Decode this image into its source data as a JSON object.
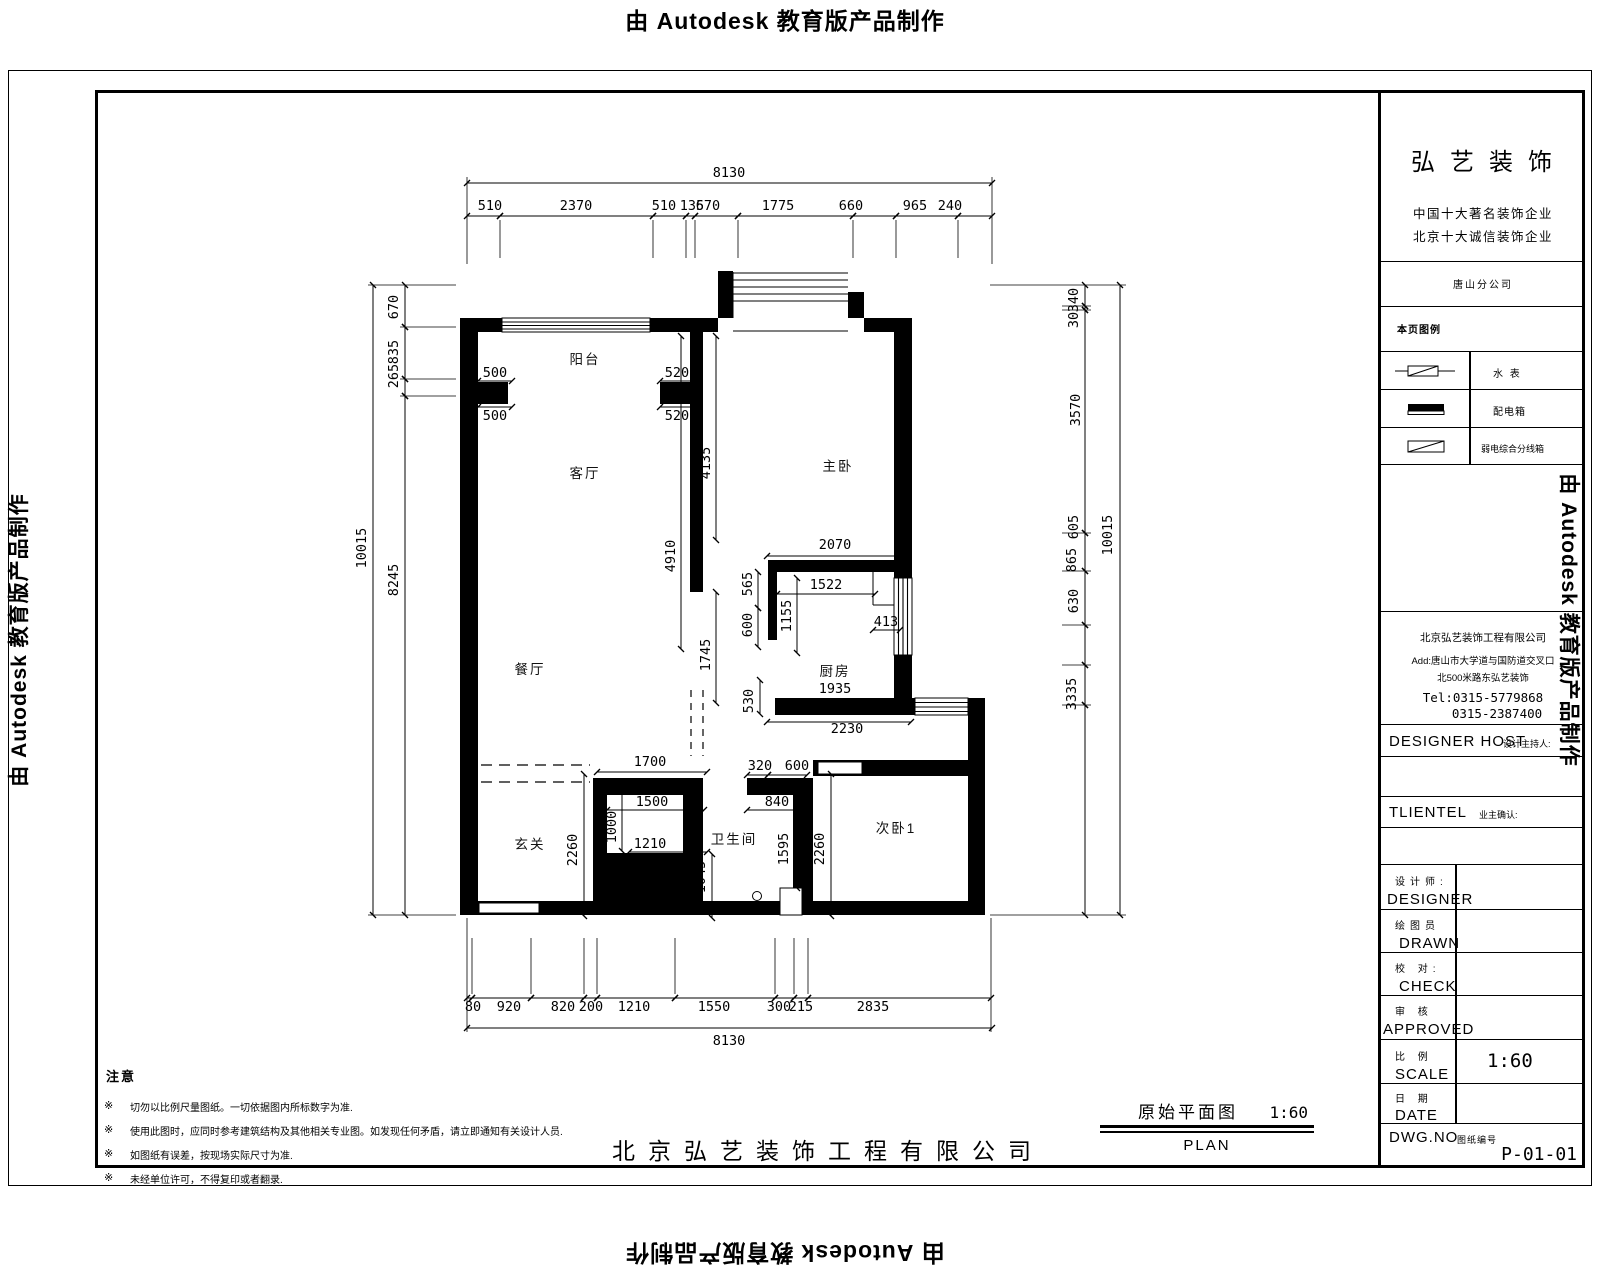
{
  "watermark": {
    "pre": "由",
    "brand": "Autodesk",
    "post": "教育版产品制作"
  },
  "title_block": {
    "logo": "弘艺装饰",
    "slogan1": "中国十大著名装饰企业",
    "slogan2": "北京十大诚信装饰企业",
    "branch": "唐山分公司",
    "legend_title": "本页图例",
    "legend": [
      {
        "icon": "water-meter",
        "label": "水  表"
      },
      {
        "icon": "distribution-box",
        "label": "配电箱"
      },
      {
        "icon": "weak-current-box",
        "label": "弱电综合分线箱"
      }
    ],
    "company": "北京弘艺装饰工程有限公司",
    "address1": "Add:唐山市大学道与国防道交叉口",
    "address2": "北500米路东弘艺装饰",
    "tel1": "Tel:0315-5779868",
    "tel2": "0315-2387400",
    "host_en": "DESIGNER HOST",
    "host_zh": "设计主持人:",
    "client_en": "TLIENTEL",
    "client_zh": "业主确认:",
    "rows": [
      {
        "zh": "设计师:",
        "en": "DESIGNER",
        "value": ""
      },
      {
        "zh": "绘图员",
        "en": "DRAWN",
        "value": ""
      },
      {
        "zh": "校  对:",
        "en": "CHECK",
        "value": ""
      },
      {
        "zh": "审  核",
        "en": "APPROVED",
        "value": ""
      },
      {
        "zh": "比  例",
        "en": "SCALE",
        "value": "1:60"
      },
      {
        "zh": "日  期",
        "en": "DATE",
        "value": ""
      }
    ],
    "dwg_label": "DWG.NO",
    "dwg_zh": "图纸编号",
    "dwg_no": "P-01-01"
  },
  "notes": {
    "title": "注意",
    "bullet": "※",
    "items": [
      "切勿以比例尺量图纸。一切依据图内所标数字为准.",
      "使用此图时，应同时参考建筑结构及其他相关专业图。如发现任何矛盾，请立即通知有关设计人员.",
      "如图纸有误差，按现场实际尺寸为准.",
      "未经单位许可，不得复印或者翻录."
    ]
  },
  "footer": {
    "company": "北京弘艺装饰工程有限公司"
  },
  "drawing_title": {
    "zh": "原始平面图",
    "scale": "1:60",
    "en": "PLAN"
  },
  "plan": {
    "rooms": {
      "balcony": "阳台",
      "living": "客厅",
      "dining": "餐厅",
      "master": "主卧",
      "kitchen": "厨房",
      "entry": "玄关",
      "bath": "卫生间",
      "bedroom2": "次卧1"
    },
    "dims": {
      "top_total": "8130",
      "top": [
        "510",
        "2370",
        "510",
        "135",
        "670",
        "1775",
        "660",
        "965",
        "240"
      ],
      "bottom": [
        "80",
        "920",
        "820",
        "200",
        "1210",
        "1550",
        "300",
        "215",
        "2835"
      ],
      "bottom_total": "8130",
      "left_total": "10015",
      "left": [
        "670",
        "835",
        "265",
        "8245"
      ],
      "right": [
        "340",
        "30",
        "3570",
        "605",
        "865",
        "630",
        "3335"
      ],
      "right_total": "10015",
      "piers": [
        "500",
        "500",
        "520",
        "520"
      ],
      "inner": [
        "4135",
        "4910",
        "565",
        "600",
        "1745",
        "530",
        "2070",
        "1522",
        "1155",
        "413",
        "1935",
        "2230",
        "1700",
        "320",
        "600",
        "1500",
        "840",
        "1000",
        "1210",
        "2260",
        "1045",
        "1595",
        "2260"
      ]
    }
  }
}
